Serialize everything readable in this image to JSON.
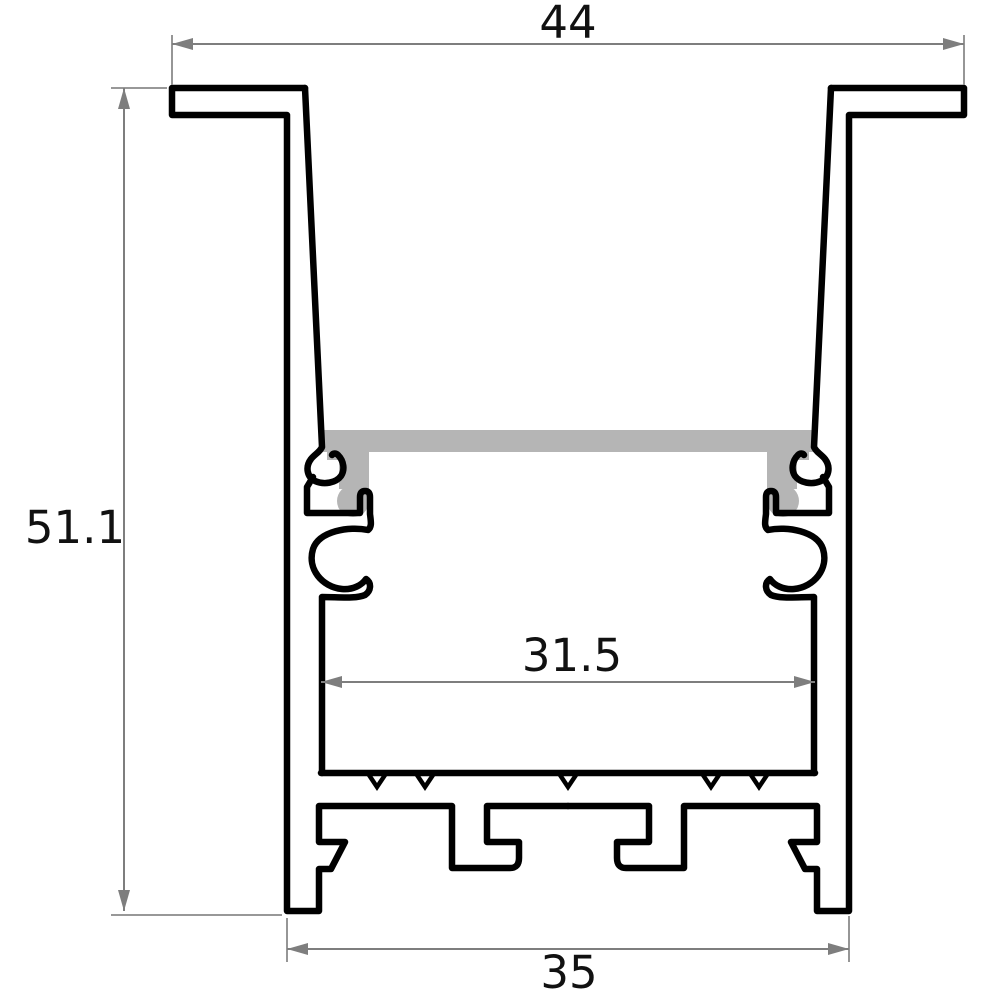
{
  "drawing": {
    "type": "technical-cross-section",
    "subject": "recessed aluminum LED profile extrusion with diffuser cover",
    "dimensions": {
      "top_width": "44",
      "overall_height": "51.1",
      "inner_width": "31.5",
      "bottom_width": "35"
    },
    "colors": {
      "outline": "#000000",
      "dimension_lines": "#7e7e7e",
      "dimension_text": "#111111",
      "diffuser_fill": "#b5b5b5",
      "background": "#ffffff"
    }
  }
}
